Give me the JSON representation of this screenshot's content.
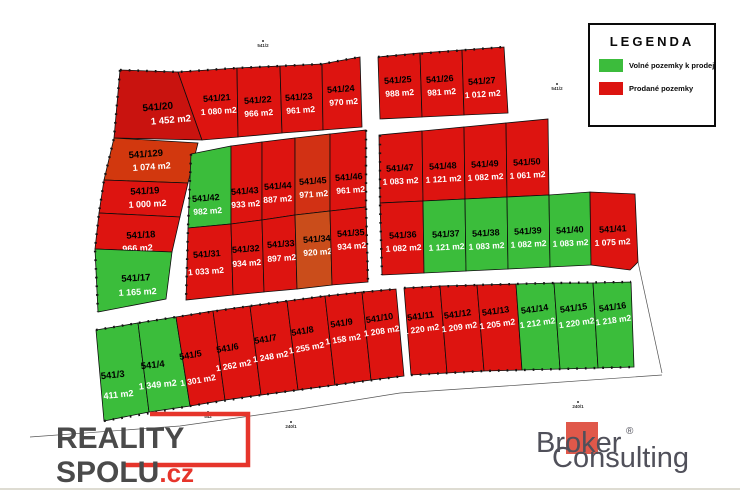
{
  "legend": {
    "title": "LEGENDA",
    "items": [
      {
        "label": "Volné pozemky k prodeji",
        "color": "#3cbc3c"
      },
      {
        "label": "Prodané pozemky",
        "color": "#dc1410"
      }
    ]
  },
  "branding": {
    "reality": {
      "line1": "REALITY",
      "line2": "SPOLU",
      "tld": ".cz",
      "accent": "#e6352b",
      "text_color": "#4a4a4a"
    },
    "broker": {
      "word1": "Broker",
      "reg": "®",
      "word2": "Consulting",
      "square_color": "#e0584a",
      "text_color": "#50505a"
    }
  },
  "map": {
    "colors": {
      "free": "#3bbd3b",
      "sold": "#dd1410",
      "border": "#0d0d0d",
      "number_text": "#000000",
      "area_text": "#ffffff"
    },
    "plots": [
      {
        "number": "541/20",
        "area": "1 452 m2",
        "status": "sold",
        "shade": "#c9130f",
        "points": "120,70 178,72 202,140 114,138",
        "nx": 158,
        "ny": 110,
        "ax": 170,
        "ay": 124,
        "fs": 10,
        "rot": -5
      },
      {
        "number": "541/129",
        "area": "1 074 m2",
        "status": "sold",
        "shade": "#d2380e",
        "points": "114,138 198,143 188,183 104,180",
        "nx": 146,
        "ny": 157,
        "ax": 151,
        "ay": 170,
        "fs": 9.5,
        "rot": -4
      },
      {
        "number": "541/19",
        "area": "1 000 m2",
        "status": "sold",
        "points": "104,180 188,183 180,217 99,213",
        "nx": 145,
        "ny": 194,
        "ax": 147,
        "ay": 207,
        "fs": 9.5,
        "rot": -3
      },
      {
        "number": "541/18",
        "area": "966 m2",
        "status": "sold",
        "points": "99,213 180,217 172,252 95,249",
        "nx": 141,
        "ny": 238,
        "ax": 137,
        "ay": 251,
        "fs": 9.5,
        "rot": -3
      },
      {
        "number": "541/17",
        "area": "1 165 m2",
        "status": "free",
        "points": "95,249 172,252 166,299 98,312",
        "nx": 136,
        "ny": 281,
        "ax": 137,
        "ay": 295,
        "fs": 9.5,
        "rot": -3
      },
      {
        "number": "541/21",
        "area": "1 080 m2",
        "status": "sold",
        "points": "178,72 237,68 238,137 202,140",
        "nx": 217,
        "ny": 101,
        "ax": 218,
        "ay": 114,
        "fs": 9,
        "rot": -4
      },
      {
        "number": "541/22",
        "area": "966 m2",
        "status": "sold",
        "points": "237,68 280,66 282,133 238,137",
        "nx": 258,
        "ny": 103,
        "ax": 258,
        "ay": 116,
        "fs": 9,
        "rot": -4
      },
      {
        "number": "541/23",
        "area": "961 m2",
        "status": "sold",
        "points": "280,66 322,64 323,130 282,133",
        "nx": 299,
        "ny": 100,
        "ax": 300,
        "ay": 113,
        "fs": 9,
        "rot": -4
      },
      {
        "number": "541/24",
        "area": "970 m2",
        "status": "sold",
        "points": "322,64 360,57 362,127 323,130",
        "nx": 341,
        "ny": 92,
        "ax": 343,
        "ay": 105,
        "fs": 9,
        "rot": -4
      },
      {
        "number": "541/25",
        "area": "988 m2",
        "status": "sold",
        "points": "378,57 420,53 422,117 380,119",
        "nx": 398,
        "ny": 83,
        "ax": 399,
        "ay": 96,
        "fs": 9,
        "rot": -4
      },
      {
        "number": "541/26",
        "area": "981 m2",
        "status": "sold",
        "points": "420,53 462,50 464,115 422,117",
        "nx": 440,
        "ny": 82,
        "ax": 441,
        "ay": 95,
        "fs": 9,
        "rot": -4
      },
      {
        "number": "541/27",
        "area": "1 012 m2",
        "status": "sold",
        "points": "462,50 504,47 508,113 464,115",
        "nx": 482,
        "ny": 84,
        "ax": 482,
        "ay": 97,
        "fs": 9,
        "rot": -4
      },
      {
        "number": "541/42",
        "area": "982 m2",
        "status": "free",
        "points": "191,154 231,146 231,224 188,228",
        "nx": 206,
        "ny": 201,
        "ax": 207,
        "ay": 214,
        "fs": 9,
        "rot": -4
      },
      {
        "number": "541/43",
        "area": "933 m2",
        "status": "sold",
        "points": "231,146 262,142 262,220 231,224",
        "nx": 245,
        "ny": 194,
        "ax": 245,
        "ay": 207,
        "fs": 9,
        "rot": -4
      },
      {
        "number": "541/44",
        "area": "887 m2",
        "status": "sold",
        "points": "262,142 295,138 295,215 262,220",
        "nx": 278,
        "ny": 189,
        "ax": 277,
        "ay": 202,
        "fs": 9,
        "rot": -4
      },
      {
        "number": "541/45",
        "area": "971 m2",
        "status": "sold",
        "shade": "#d23114",
        "points": "295,138 330,134 330,211 295,215",
        "nx": 313,
        "ny": 184,
        "ax": 313,
        "ay": 197,
        "fs": 9,
        "rot": -4
      },
      {
        "number": "541/46",
        "area": "961 m2",
        "status": "sold",
        "points": "330,134 366,130 366,207 330,211",
        "nx": 349,
        "ny": 180,
        "ax": 350,
        "ay": 193,
        "fs": 9,
        "rot": -4
      },
      {
        "number": "541/31",
        "area": "1 033 m2",
        "status": "sold",
        "points": "188,228 231,224 233,295 186,300",
        "nx": 207,
        "ny": 257,
        "ax": 205,
        "ay": 274,
        "fs": 9,
        "rot": -4
      },
      {
        "number": "541/32",
        "area": "934 m2",
        "status": "sold",
        "points": "231,224 262,220 264,292 233,295",
        "nx": 246,
        "ny": 252,
        "ax": 246,
        "ay": 266,
        "fs": 9,
        "rot": -4
      },
      {
        "number": "541/33",
        "area": "897 m2",
        "status": "sold",
        "points": "262,220 295,215 297,289 264,292",
        "nx": 281,
        "ny": 247,
        "ax": 281,
        "ay": 261,
        "fs": 9,
        "rot": -4
      },
      {
        "number": "541/34",
        "area": "920 m2",
        "status": "sold",
        "shade": "#ca4d1b",
        "points": "295,215 330,211 332,285 297,289",
        "nx": 317,
        "ny": 242,
        "ax": 317,
        "ay": 255,
        "fs": 9,
        "rot": -4
      },
      {
        "number": "541/35",
        "area": "934 m2",
        "status": "sold",
        "points": "330,211 366,207 368,282 332,285",
        "nx": 351,
        "ny": 236,
        "ax": 351,
        "ay": 249,
        "fs": 9,
        "rot": -4
      },
      {
        "number": "541/47",
        "area": "1 083 m2",
        "status": "sold",
        "points": "379,135 422,131 423,201 380,203",
        "nx": 400,
        "ny": 171,
        "ax": 400,
        "ay": 184,
        "fs": 9,
        "rot": -3
      },
      {
        "number": "541/48",
        "area": "1 121 m2",
        "status": "sold",
        "points": "422,131 464,127 465,199 423,201",
        "nx": 443,
        "ny": 169,
        "ax": 443,
        "ay": 182,
        "fs": 9,
        "rot": -3
      },
      {
        "number": "541/49",
        "area": "1 082 m2",
        "status": "sold",
        "points": "464,127 506,123 507,197 465,199",
        "nx": 485,
        "ny": 167,
        "ax": 485,
        "ay": 180,
        "fs": 9,
        "rot": -3
      },
      {
        "number": "541/50",
        "area": "1 061 m2",
        "status": "sold",
        "points": "506,123 548,119 549,195 507,197",
        "nx": 527,
        "ny": 165,
        "ax": 527,
        "ay": 178,
        "fs": 9,
        "rot": -3
      },
      {
        "number": "541/36",
        "area": "1 082 m2",
        "status": "sold",
        "points": "380,203 423,201 424,273 382,275",
        "nx": 403,
        "ny": 238,
        "ax": 403,
        "ay": 251,
        "fs": 9,
        "rot": -3
      },
      {
        "number": "541/37",
        "area": "1 121 m2",
        "status": "free",
        "points": "423,201 465,199 466,271 424,273",
        "nx": 446,
        "ny": 237,
        "ax": 446,
        "ay": 250,
        "fs": 9,
        "rot": -3
      },
      {
        "number": "541/38",
        "area": "1 083 m2",
        "status": "free",
        "points": "465,199 507,197 508,269 466,271",
        "nx": 486,
        "ny": 236,
        "ax": 486,
        "ay": 249,
        "fs": 9,
        "rot": -3
      },
      {
        "number": "541/39",
        "area": "1 082 m2",
        "status": "free",
        "points": "507,197 549,195 550,267 508,269",
        "nx": 528,
        "ny": 234,
        "ax": 528,
        "ay": 247,
        "fs": 9,
        "rot": -3
      },
      {
        "number": "541/40",
        "area": "1 083 m2",
        "status": "free",
        "points": "549,195 590,192 591,265 550,267",
        "nx": 570,
        "ny": 233,
        "ax": 570,
        "ay": 246,
        "fs": 9,
        "rot": -3
      },
      {
        "number": "541/41",
        "area": "1 075 m2",
        "status": "sold",
        "points": "590,192 635,194 638,262 630,270 591,265",
        "nx": 613,
        "ny": 232,
        "ax": 612,
        "ay": 245,
        "fs": 9,
        "rot": -3
      },
      {
        "number": "541/3",
        "area": "1 411 m2",
        "status": "free",
        "points": "96,330 138,323 149,412 104,421",
        "nx": 113,
        "ny": 378,
        "ax": 113,
        "ay": 398,
        "fs": 9.5,
        "rot": -6
      },
      {
        "number": "541/4",
        "area": "1 349 m2",
        "status": "free",
        "points": "138,323 176,317 190,406 149,412",
        "nx": 153,
        "ny": 368,
        "ax": 156,
        "ay": 388,
        "fs": 9.5,
        "rot": -6
      },
      {
        "number": "541/5",
        "area": "1 301 m2",
        "status": "sold",
        "points": "176,317 213,311 225,400 190,406",
        "nx": 191,
        "ny": 358,
        "ax": 194,
        "ay": 384,
        "fs": 9,
        "rot": -10
      },
      {
        "number": "541/6",
        "area": "1 262 m2",
        "status": "sold",
        "points": "213,311 250,306 261,395 225,400",
        "nx": 228,
        "ny": 351,
        "ax": 231,
        "ay": 369,
        "fs": 9,
        "rot": -10
      },
      {
        "number": "541/7",
        "area": "1 248 m2",
        "status": "sold",
        "points": "250,306 287,301 298,390 261,395",
        "nx": 266,
        "ny": 342,
        "ax": 268,
        "ay": 360,
        "fs": 9,
        "rot": -10
      },
      {
        "number": "541/8",
        "area": "1 255 m2",
        "status": "sold",
        "points": "287,301 325,296 335,385 298,390",
        "nx": 303,
        "ny": 334,
        "ax": 304,
        "ay": 351,
        "fs": 9,
        "rot": -10
      },
      {
        "number": "541/9",
        "area": "1 158 m2",
        "status": "sold",
        "points": "325,296 362,292 371,380 335,385",
        "nx": 342,
        "ny": 326,
        "ax": 341,
        "ay": 342,
        "fs": 9,
        "rot": -9
      },
      {
        "number": "541/10",
        "area": "1 208 m2",
        "status": "sold",
        "points": "362,292 396,289 404,376 371,380",
        "nx": 380,
        "ny": 321,
        "ax": 380,
        "ay": 334,
        "fs": 9,
        "rot": -9
      },
      {
        "number": "541/11",
        "area": "1 220 m2",
        "status": "sold",
        "points": "404,288 440,286 447,373 411,375",
        "nx": 421,
        "ny": 319,
        "ax": 420,
        "ay": 332,
        "fs": 9,
        "rot": -8
      },
      {
        "number": "541/12",
        "area": "1 209 m2",
        "status": "sold",
        "points": "440,286 477,285 484,371 447,373",
        "nx": 458,
        "ny": 317,
        "ax": 458,
        "ay": 330,
        "fs": 9,
        "rot": -8
      },
      {
        "number": "541/13",
        "area": "1 205 m2",
        "status": "sold",
        "points": "477,285 516,284 522,370 484,371",
        "nx": 496,
        "ny": 314,
        "ax": 496,
        "ay": 327,
        "fs": 9,
        "rot": -8
      },
      {
        "number": "541/14",
        "area": "1 212 m2",
        "status": "free",
        "points": "516,284 554,283 560,369 522,370",
        "nx": 535,
        "ny": 312,
        "ax": 536,
        "ay": 326,
        "fs": 9,
        "rot": -8
      },
      {
        "number": "541/15",
        "area": "1 220 m2",
        "status": "free",
        "points": "554,283 593,283 598,368 560,369",
        "nx": 574,
        "ny": 311,
        "ax": 575,
        "ay": 326,
        "fs": 9,
        "rot": -8
      },
      {
        "number": "541/16",
        "area": "1 218 m2",
        "status": "free",
        "points": "593,283 631,282 634,367 598,368",
        "nx": 613,
        "ny": 310,
        "ax": 612,
        "ay": 323,
        "fs": 9,
        "rot": -8
      }
    ],
    "ticklines": [
      "120,70 178,72 237,68 280,66 322,64 360,57",
      "378,57 504,47",
      "120,70 114,138 104,180 99,213 95,249 98,312",
      "96,330 138,323 176,317 250,306 325,296 396,289",
      "404,288 477,285 554,283 631,282",
      "104,421 190,406 261,395 335,385 404,376",
      "411,375 484,371 560,369 634,367",
      "191,154 188,228 186,300",
      "380,135 380,203 382,275",
      "366,130 366,207 368,282"
    ],
    "thin_lines": [
      "30,437 180,426 300,409 400,393 520,385 662,375",
      "638,262 662,373"
    ],
    "ref_labels": [
      {
        "text": "541/2",
        "x": 263,
        "y": 47
      },
      {
        "text": "541/2",
        "x": 557,
        "y": 90
      },
      {
        "text": "542",
        "x": 208,
        "y": 418
      },
      {
        "text": "240/1",
        "x": 291,
        "y": 428
      },
      {
        "text": "240/1",
        "x": 578,
        "y": 408
      }
    ]
  }
}
